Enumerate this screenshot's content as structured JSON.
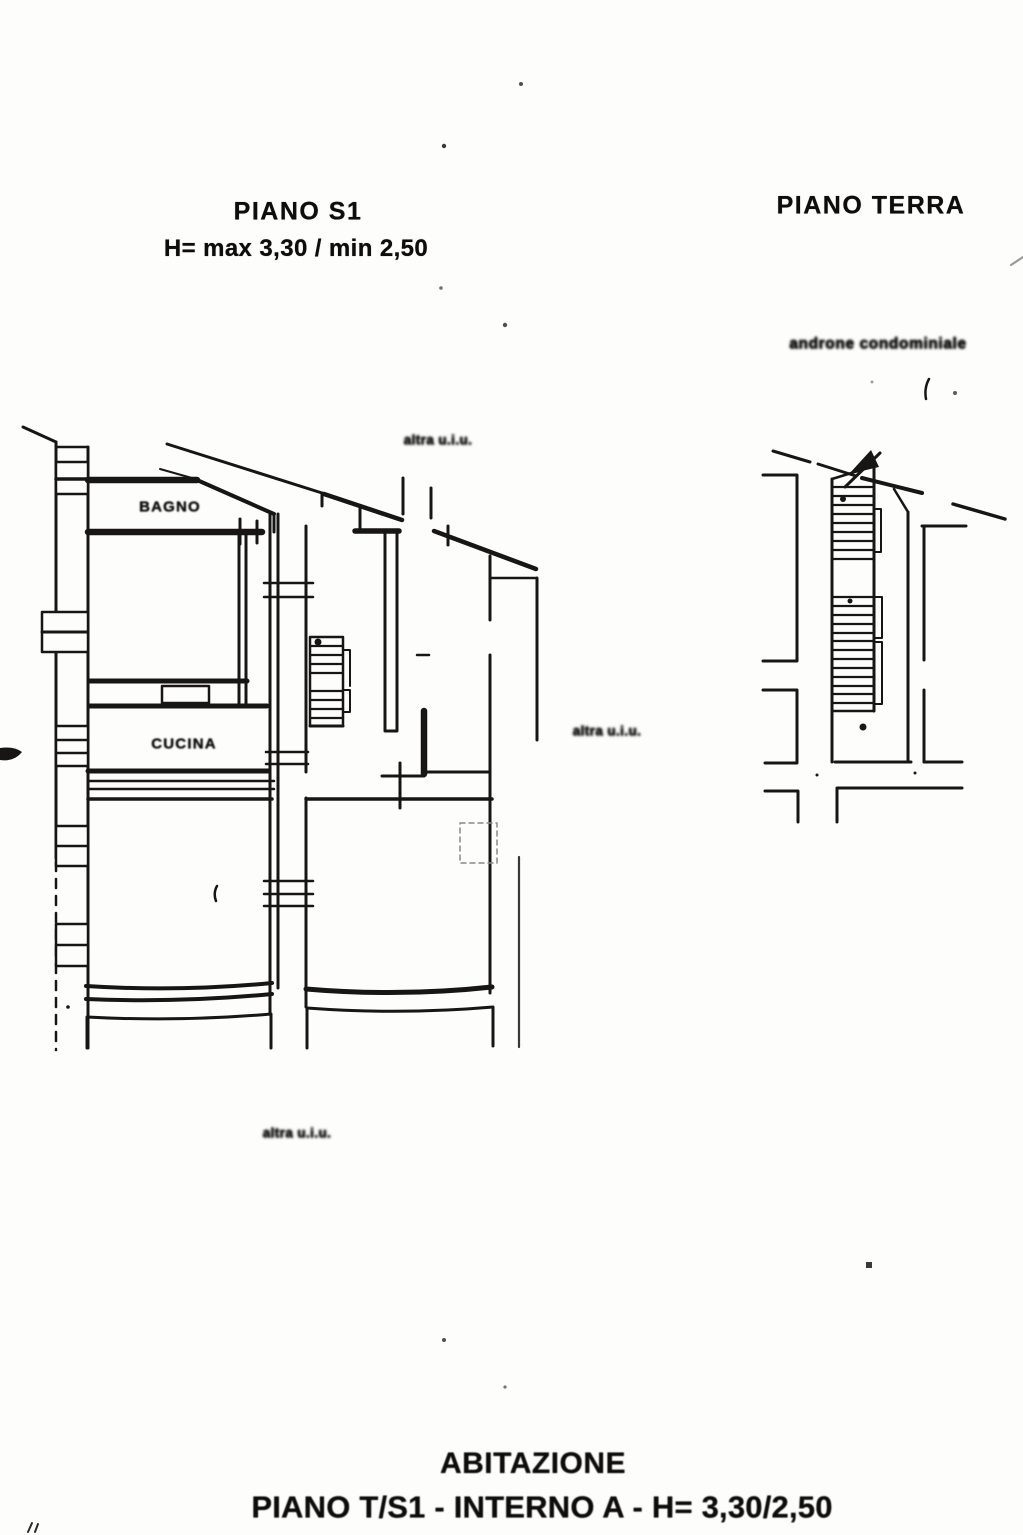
{
  "page": {
    "paper_color": "#fdfdfc",
    "ink_color": "#181614"
  },
  "plan_s1": {
    "title": "PIANO S1",
    "height_note": "H= max 3,30 / min 2,50",
    "rooms": [
      {
        "label": "BAGNO"
      },
      {
        "label": "CUCINA"
      }
    ],
    "adjacent_units": [
      {
        "label": "altra u.i.u."
      },
      {
        "label": "altra u.i.u."
      },
      {
        "label": "altra u.i.u."
      }
    ]
  },
  "plan_terra": {
    "title": "PIANO TERRA",
    "annotation": "androne condominiale"
  },
  "caption": {
    "line1": "ABITAZIONE",
    "line2": "PIANO T/S1 - INTERNO A - H= 3,30/2,50"
  }
}
